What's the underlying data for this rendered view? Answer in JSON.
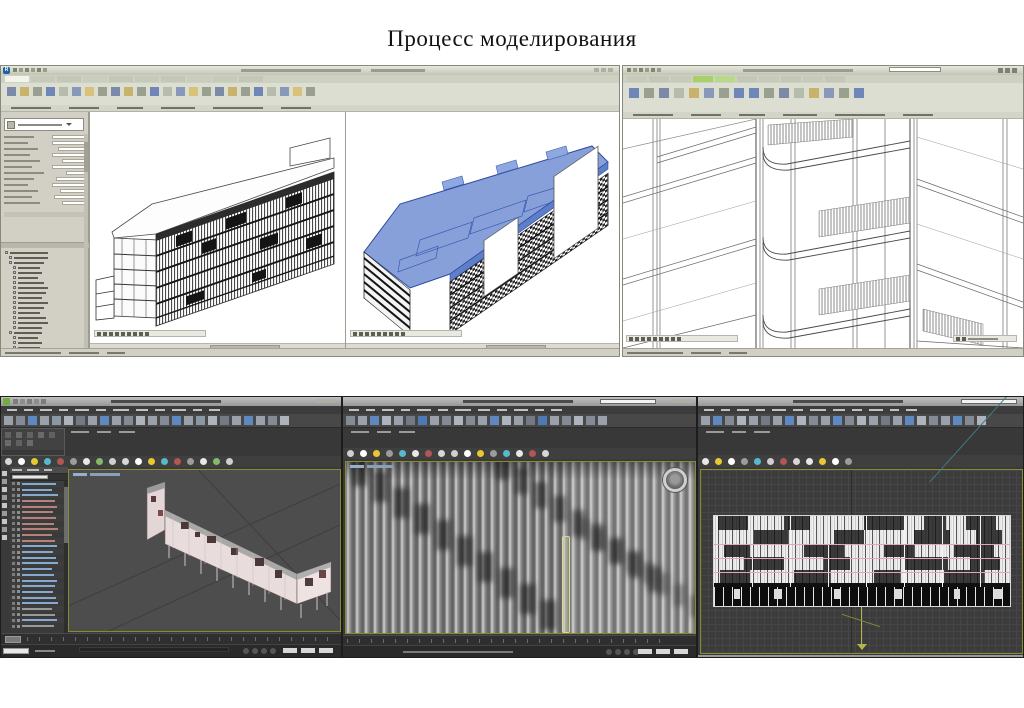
{
  "slide": {
    "title": "Процесс моделирования"
  },
  "icons": {
    "revit_logo_letter": "R",
    "max_logo": "3dsmax-green-swirl",
    "steering_wheel": "navigation-wheel",
    "viewcube": "none-visible"
  },
  "colors": {
    "revit_chrome": "#d8dacd",
    "revit_tab_active_green": "#a8d06a",
    "selection_blue": "#7e99d6",
    "max_titlebar": "#a8a8a8",
    "max_chrome": "#454545",
    "viewport_border_olive": "#8a8a2e",
    "facade_pink_line": "#e7a3b8",
    "axis_yellow": "#b6b648",
    "explorer_text_blue": "#86a9cf"
  },
  "gen": {
    "qatL": {
      "n": 6,
      "w": 4,
      "h": 4,
      "gap": 2,
      "colors": [
        "#83866f",
        "#9a9d8e"
      ],
      "name": "quick-access-icon",
      "inter": true
    },
    "titleDashL": {
      "n": 2,
      "w": [
        120,
        54
      ],
      "h": 3,
      "gap": 10,
      "colors": [
        "#999c8e"
      ],
      "name": "window-title-text",
      "inter": false
    },
    "winBtns": {
      "n": 3,
      "w": 5,
      "h": 4,
      "gap": 2,
      "colors": [
        "#aeb1a2"
      ],
      "name": "window-control-button",
      "inter": true
    },
    "tabsL": {
      "n": 10,
      "w": 24,
      "h": 6,
      "gap": 2,
      "colors": [
        "#f2f3ea",
        "#c6cabb",
        "#c3c7b8",
        "#c9cdbd",
        "#c3c7b8",
        "#c6cabb",
        "#c3c7b8",
        "#c9cdbd",
        "#c6cabb",
        "#c3c7b8"
      ],
      "name": "ribbon-tab",
      "inter": true
    },
    "ribbonIconsL": {
      "n": 24,
      "w": 9,
      "h": 9,
      "gap": 4,
      "colors": [
        "#7b8aa8",
        "#c9b26a",
        "#9aa08f",
        "#6f87b8",
        "#b5bcab",
        "#8898b8",
        "#d8c27a",
        "#9aa08f"
      ],
      "name": "ribbon-tool-icon",
      "inter": true
    },
    "panelLabelsL": {
      "n": 6,
      "w": [
        40,
        30,
        26,
        34,
        50,
        30
      ],
      "h": 2,
      "gap": 18,
      "colors": [
        "#6f7265"
      ],
      "name": "ribbon-panel-label",
      "inter": false
    },
    "statusDashes": {
      "n": 3,
      "w": [
        56,
        30,
        18
      ],
      "h": 2,
      "gap": 8,
      "colors": [
        "#7a776d"
      ],
      "name": "status-text",
      "inter": false
    },
    "viewbar": {
      "n": 9,
      "w": 4,
      "h": 4,
      "gap": 2,
      "colors": [
        "#5d5f55"
      ],
      "name": "view-control-icon",
      "inter": true
    },
    "qatR": {
      "n": 6,
      "w": 4,
      "h": 4,
      "gap": 2,
      "colors": [
        "#83866f",
        "#9a9d8e"
      ],
      "name": "quick-access-icon",
      "inter": true
    },
    "tabsR": {
      "n": 10,
      "w": 20,
      "h": 6,
      "gap": 2,
      "colors": [
        "#c6cabb",
        "#c3c7b8",
        "#c6cabb",
        "#a8d06a",
        "#b9d98a",
        "#c3c7b8",
        "#c6cabb",
        "#c3c7b8",
        "#c6cabb",
        "#c3c7b8"
      ],
      "name": "ribbon-tab",
      "inter": true
    },
    "ribbonIconsR": {
      "n": 16,
      "w": 10,
      "h": 10,
      "gap": 5,
      "colors": [
        "#6f87b8",
        "#9aa08f",
        "#7b8aa8",
        "#b5bcab",
        "#c9b26a",
        "#8898b8",
        "#9aa08f",
        "#6f87b8"
      ],
      "name": "ribbon-tool-icon",
      "inter": true
    },
    "searchIcons": {
      "n": 3,
      "w": 5,
      "h": 5,
      "gap": 2,
      "colors": [
        "#7d8073"
      ],
      "name": "titlebar-icon",
      "inter": true
    },
    "menus": {
      "n": 12,
      "w": [
        10,
        9,
        12,
        9,
        14,
        10,
        16,
        12,
        10,
        14,
        9,
        11
      ],
      "h": 2,
      "gap": 7,
      "colors": [
        "#c2c2c2"
      ],
      "name": "menu-item",
      "inter": true
    },
    "maxToolbarA": {
      "n": 24,
      "w": 9,
      "h": 9,
      "gap": 3,
      "colors": [
        "#9aa1ab",
        "#848b95",
        "#5f87c0",
        "#9aa1ab",
        "#8a97a5",
        "#aeb4bc",
        "#737a84",
        "#9aa1ab",
        "#5f87c0",
        "#9aa1ab",
        "#848b95",
        "#aeb4bc"
      ],
      "name": "toolbar-icon",
      "inter": true
    },
    "maxToolbarB": {
      "n": 22,
      "w": 9,
      "h": 9,
      "gap": 3,
      "colors": [
        "#848b95",
        "#9aa1ab",
        "#5f87c0",
        "#aeb4bc",
        "#9aa1ab",
        "#737a84",
        "#4f79b5",
        "#9aa1ab",
        "#848b95",
        "#aeb4bc"
      ],
      "name": "toolbar-icon",
      "inter": true
    },
    "maxToolbarC": {
      "n": 24,
      "w": 9,
      "h": 9,
      "gap": 3,
      "colors": [
        "#9aa1ab",
        "#5f87c0",
        "#848b95",
        "#aeb4bc",
        "#9aa1ab",
        "#737a84",
        "#9aa1ab",
        "#5f87c0",
        "#aeb4bc",
        "#848b95"
      ],
      "name": "toolbar-icon",
      "inter": true
    },
    "dotRowA": {
      "n": 18,
      "w": 7,
      "h": 7,
      "gap": 6,
      "radius": "50%",
      "colors": [
        "#d7d7d7",
        "#ffffff",
        "#e7c832",
        "#57b9cd",
        "#b25555",
        "#9c9c9c",
        "#e8e8e8",
        "#86b86a",
        "#cfcfcf"
      ],
      "name": "snap-toggle-icon",
      "inter": true
    },
    "dotRowB": {
      "n": 16,
      "w": 7,
      "h": 7,
      "gap": 6,
      "radius": "50%",
      "colors": [
        "#cfcfcf",
        "#ffffff",
        "#e7c832",
        "#9c9c9c",
        "#57b9cd",
        "#e8e8e8",
        "#b25555",
        "#d7d7d7"
      ],
      "name": "snap-toggle-icon",
      "inter": true
    },
    "dotRowC": {
      "n": 12,
      "w": 7,
      "h": 7,
      "gap": 6,
      "radius": "50%",
      "colors": [
        "#e8e8e8",
        "#e7c832",
        "#ffffff",
        "#9c9c9c",
        "#57b9cd",
        "#cfcfcf",
        "#b25555",
        "#d7d7d7"
      ],
      "name": "snap-toggle-icon",
      "inter": true
    },
    "ribbonBtnsA": {
      "n": 8,
      "w": 6,
      "h": 6,
      "gap": 3,
      "colors": [
        "#616161",
        "#6a6a6a"
      ],
      "name": "graphite-ribbon-button",
      "inter": true
    },
    "leftToolCol": {
      "n": 9,
      "w": 5,
      "h": 5,
      "gap": 3,
      "dir": "col",
      "colors": [
        "#c7c7c7",
        "#9a9a9a"
      ],
      "name": "side-tool-icon",
      "inter": true
    },
    "ticksA": {
      "n": 26,
      "w": 1,
      "h": 4,
      "gap": 11,
      "colors": [
        "#6a6a6a"
      ],
      "name": "timeline-tick",
      "inter": false
    },
    "ticksB": {
      "n": 27,
      "w": 1,
      "h": 4,
      "gap": 11,
      "colors": [
        "#6a6a6a"
      ],
      "name": "timeline-tick",
      "inter": false
    },
    "transport": {
      "n": 4,
      "w": 6,
      "h": 6,
      "gap": 3,
      "radius": "50%",
      "colors": [
        "#565656"
      ],
      "name": "transport-button",
      "inter": true
    },
    "coordBoxes": {
      "n": 3,
      "w": 14,
      "h": 5,
      "gap": 4,
      "colors": [
        "#d8d8d8"
      ],
      "name": "coordinate-field",
      "inter": true
    },
    "xpHead": {
      "n": 3,
      "w": [
        10,
        12,
        8
      ],
      "h": 2,
      "gap": 5,
      "colors": [
        "#bdbdbd"
      ],
      "name": "explorer-header-text",
      "inter": false
    },
    "vplabelA": {
      "n": 2,
      "w": [
        14,
        30
      ],
      "h": 3,
      "gap": 3,
      "colors": [
        "#9ab0c8",
        "#8aa0b8"
      ],
      "name": "viewport-label",
      "inter": true
    },
    "vplabelB": {
      "n": 2,
      "w": [
        14,
        26
      ],
      "h": 3,
      "gap": 3,
      "colors": [
        "#9ab0c8",
        "#8aa0b8"
      ],
      "name": "viewport-label",
      "inter": true
    },
    "titleDashMax": {
      "n": 1,
      "w": [
        110
      ],
      "h": 3,
      "gap": 0,
      "colors": [
        "#4a4a4a"
      ],
      "name": "window-title-text",
      "inter": false
    },
    "projBar": {
      "n": 5,
      "w": 5,
      "h": 5,
      "gap": 2,
      "colors": [
        "#7d7d7d",
        "#8d8d8d"
      ],
      "name": "project-toolbar-icon",
      "inter": true
    },
    "tabDashes": {
      "n": 3,
      "w": [
        18,
        14,
        16
      ],
      "h": 2,
      "gap": 8,
      "colors": [
        "#9a9a9a"
      ],
      "name": "ribbon-tab-label",
      "inter": true
    }
  },
  "props": {
    "rows": [
      {
        "lw": 30,
        "vw": 34
      },
      {
        "lw": 24,
        "vw": 34
      },
      {
        "lw": 34,
        "vw": 28
      },
      {
        "lw": 26,
        "vw": 34
      },
      {
        "lw": 36,
        "vw": 24
      },
      {
        "lw": 28,
        "vw": 34
      },
      {
        "lw": 40,
        "vw": 20
      },
      {
        "lw": 30,
        "vw": 30
      },
      {
        "lw": 24,
        "vw": 34
      },
      {
        "lw": 34,
        "vw": 26
      },
      {
        "lw": 28,
        "vw": 32
      },
      {
        "lw": 36,
        "vw": 24
      }
    ]
  },
  "browser": {
    "rows": [
      {
        "ind": 2,
        "w": 38
      },
      {
        "ind": 6,
        "w": 34
      },
      {
        "ind": 6,
        "w": 30
      },
      {
        "ind": 10,
        "w": 22
      },
      {
        "ind": 10,
        "w": 24
      },
      {
        "ind": 10,
        "w": 20
      },
      {
        "ind": 10,
        "w": 26
      },
      {
        "ind": 10,
        "w": 30
      },
      {
        "ind": 10,
        "w": 28
      },
      {
        "ind": 10,
        "w": 24
      },
      {
        "ind": 10,
        "w": 30
      },
      {
        "ind": 10,
        "w": 26
      },
      {
        "ind": 10,
        "w": 22
      },
      {
        "ind": 10,
        "w": 28
      },
      {
        "ind": 10,
        "w": 30
      },
      {
        "ind": 10,
        "w": 24
      },
      {
        "ind": 6,
        "w": 28
      },
      {
        "ind": 10,
        "w": 20
      },
      {
        "ind": 10,
        "w": 24
      },
      {
        "ind": 10,
        "w": 22
      }
    ]
  },
  "explorer": {
    "rows": [
      {
        "w": 34,
        "c": "#86a9cf"
      },
      {
        "w": 30,
        "c": "#86a9cf"
      },
      {
        "w": 36,
        "c": "#86a9cf"
      },
      {
        "w": 33,
        "c": "#b5837b"
      },
      {
        "w": 35,
        "c": "#b5837b"
      },
      {
        "w": 31,
        "c": "#b5837b"
      },
      {
        "w": 34,
        "c": "#b5837b"
      },
      {
        "w": 32,
        "c": "#b5837b"
      },
      {
        "w": 36,
        "c": "#b5837b"
      },
      {
        "w": 30,
        "c": "#b5837b"
      },
      {
        "w": 33,
        "c": "#b5837b"
      },
      {
        "w": 35,
        "c": "#86a9cf"
      },
      {
        "w": 31,
        "c": "#86a9cf"
      },
      {
        "w": 34,
        "c": "#86a9cf"
      },
      {
        "w": 36,
        "c": "#86a9cf"
      },
      {
        "w": 30,
        "c": "#86a9cf"
      },
      {
        "w": 32,
        "c": "#86a9cf"
      },
      {
        "w": 35,
        "c": "#86a9cf"
      },
      {
        "w": 33,
        "c": "#86a9cf"
      },
      {
        "w": 31,
        "c": "#86a9cf"
      },
      {
        "w": 34,
        "c": "#86a9cf"
      },
      {
        "w": 36,
        "c": "#86a9cf"
      },
      {
        "w": 30,
        "c": "#9a9a9a"
      },
      {
        "w": 33,
        "c": "#9a9a9a"
      },
      {
        "w": 35,
        "c": "#86a9cf"
      },
      {
        "w": 32,
        "c": "#9a9a9a"
      }
    ]
  },
  "facade": {
    "bands": [
      {
        "h": 14,
        "patches": [
          [
            4,
            30
          ],
          [
            70,
            26
          ],
          [
            150,
            40
          ],
          [
            210,
            22
          ],
          [
            252,
            30
          ]
        ]
      },
      {
        "h": 14,
        "patches": [
          [
            40,
            34
          ],
          [
            120,
            30
          ],
          [
            200,
            36
          ],
          [
            262,
            26
          ]
        ]
      },
      {
        "h": 13,
        "patches": [
          [
            10,
            26
          ],
          [
            90,
            40
          ],
          [
            170,
            30
          ],
          [
            240,
            40
          ]
        ]
      },
      {
        "h": 13,
        "patches": [
          [
            30,
            40
          ],
          [
            110,
            26
          ],
          [
            190,
            44
          ],
          [
            256,
            30
          ]
        ]
      },
      {
        "h": 13,
        "patches": [
          [
            6,
            30
          ],
          [
            80,
            36
          ],
          [
            160,
            26
          ],
          [
            230,
            40
          ]
        ]
      }
    ],
    "pink_lines_y": [
      28,
      42,
      56
    ],
    "separators_x": [
      38,
      76,
      114,
      152,
      190,
      228,
      266
    ],
    "dark_band": {
      "y": 71,
      "h": 19,
      "blobs": [
        [
          20,
          6
        ],
        [
          60,
          8
        ],
        [
          120,
          6
        ],
        [
          180,
          8
        ],
        [
          240,
          6
        ],
        [
          280,
          8
        ]
      ]
    }
  },
  "streaks": [
    {
      "x": 6,
      "y": -6,
      "dx": 21,
      "dy": 16,
      "n": 10,
      "w": 15,
      "h": 30,
      "c": "rgba(18,18,18,0.55)"
    },
    {
      "x": 150,
      "y": -8,
      "dx": 19,
      "dy": 14,
      "n": 9,
      "w": 13,
      "h": 26,
      "c": "rgba(18,18,18,0.5)"
    },
    {
      "x": 232,
      "y": 56,
      "dx": 16,
      "dy": 11,
      "n": 8,
      "w": 11,
      "h": 22,
      "c": "rgba(40,40,40,0.38)"
    }
  ]
}
